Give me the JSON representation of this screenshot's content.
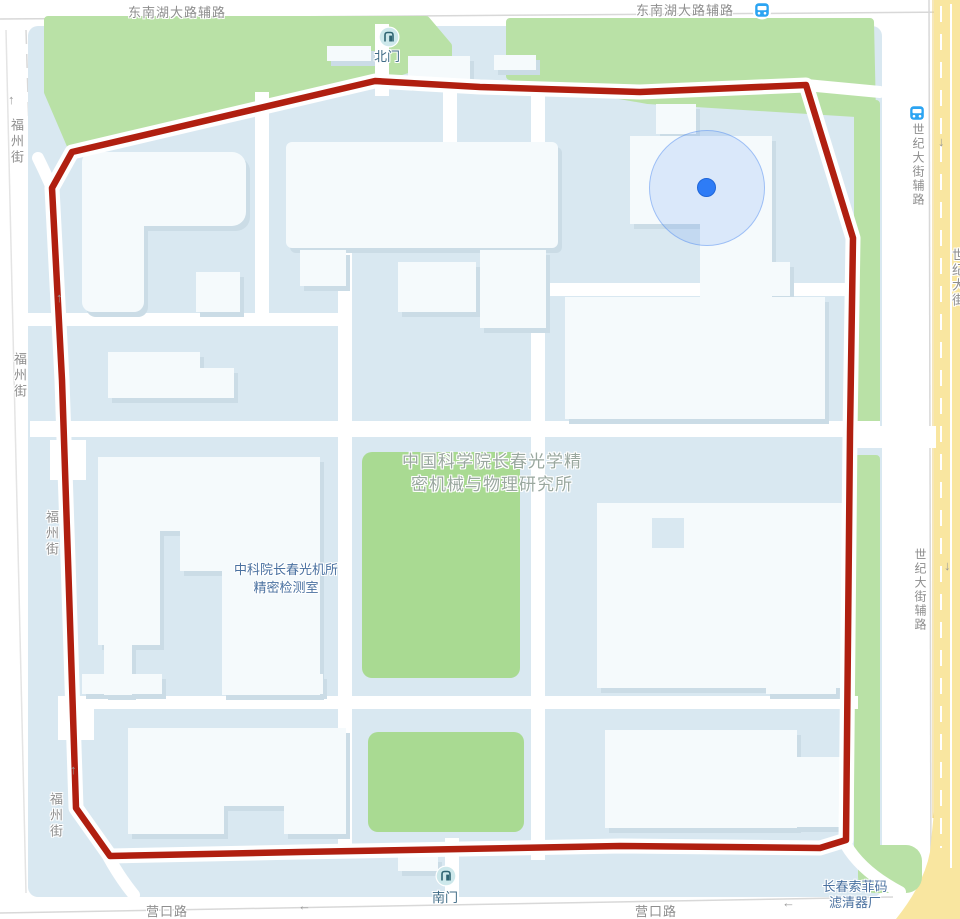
{
  "map": {
    "streets": {
      "dongnanhu": [
        "东南湖大路辅路",
        "东南湖大路辅路"
      ],
      "fuzhou": [
        "福州街",
        "福州街",
        "福州街",
        "福州街"
      ],
      "shiji_fulu": [
        "世纪大街辅路",
        "世纪大街辅路"
      ],
      "shiji": "世纪大街",
      "yingkou": [
        "营口路",
        "营口路"
      ]
    },
    "pois": {
      "north_gate": "北门",
      "south_gate": "南门",
      "campus_name_line1": "中国科学院长春光学精",
      "campus_name_line2": "密机械与物理研究所",
      "lab_line1": "中科院长春光机所",
      "lab_line2": "精密检测室",
      "factory_line1": "长春索菲码",
      "factory_line2": "滤清器厂"
    },
    "arrows": {
      "up": "↑",
      "down": "↓",
      "left": "←"
    },
    "icons": {
      "bus_stop": "bus-stop-icon",
      "gate": "gate-icon",
      "location": "current-location-dot"
    },
    "colors": {
      "route": "#b01f10",
      "location_blue": "#2e7cf6",
      "park_green": "#b9e1a6",
      "field_green": "#a9da92",
      "highway_yellow": "#f9e6a0",
      "campus_bg": "#d9e8f1"
    }
  }
}
